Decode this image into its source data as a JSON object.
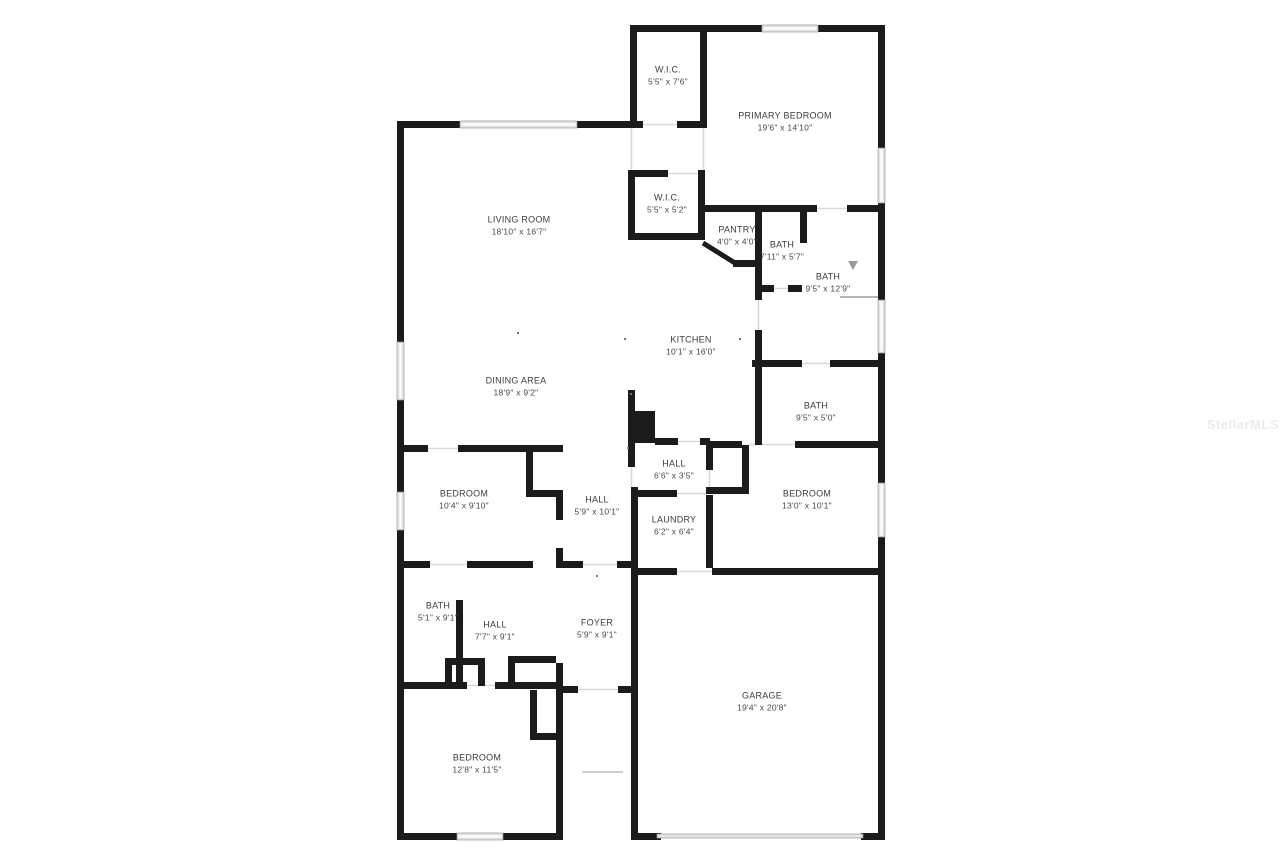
{
  "document": {
    "type": "residential-floor-plan",
    "style": "black-and-white 2D plan"
  },
  "watermark": "StellarMLS",
  "rooms": [
    {
      "id": "wic-1",
      "name": "W.I.C.",
      "dims": "5'5\" x 7'6\""
    },
    {
      "id": "primary-bedroom",
      "name": "PRIMARY BEDROOM",
      "dims": "19'6\" x 14'10\""
    },
    {
      "id": "living-room",
      "name": "LIVING ROOM",
      "dims": "18'10\" x 16'7\""
    },
    {
      "id": "wic-2",
      "name": "W.I.C.",
      "dims": "5'5\" x 5'2\""
    },
    {
      "id": "pantry",
      "name": "PANTRY",
      "dims": "4'0\" x 4'0\""
    },
    {
      "id": "bath-1",
      "name": "BATH",
      "dims": "7'11\" x 5'7\""
    },
    {
      "id": "bath-2",
      "name": "BATH",
      "dims": "9'5\" x 12'9\""
    },
    {
      "id": "kitchen",
      "name": "KITCHEN",
      "dims": "10'1\" x 16'0\""
    },
    {
      "id": "dining-area",
      "name": "DINING AREA",
      "dims": "18'9\" x 9'2\""
    },
    {
      "id": "bath-3",
      "name": "BATH",
      "dims": "9'5\" x 5'0\""
    },
    {
      "id": "hall-1",
      "name": "HALL",
      "dims": "6'6\" x 3'5\""
    },
    {
      "id": "bedroom-1",
      "name": "BEDROOM",
      "dims": "10'4\" x 9'10\""
    },
    {
      "id": "hall-2",
      "name": "HALL",
      "dims": "5'9\" x 10'1\""
    },
    {
      "id": "laundry",
      "name": "LAUNDRY",
      "dims": "6'2\" x 6'4\""
    },
    {
      "id": "bedroom-2",
      "name": "BEDROOM",
      "dims": "13'0\" x 10'1\""
    },
    {
      "id": "bath-4",
      "name": "BATH",
      "dims": "5'1\" x 9'1\""
    },
    {
      "id": "hall-3",
      "name": "HALL",
      "dims": "7'7\" x 9'1\""
    },
    {
      "id": "foyer",
      "name": "FOYER",
      "dims": "5'9\" x 9'1\""
    },
    {
      "id": "garage",
      "name": "GARAGE",
      "dims": "19'4\" x 20'8\""
    },
    {
      "id": "bedroom-3",
      "name": "BEDROOM",
      "dims": "12'8\" x 11'5\""
    }
  ],
  "colors": {
    "background": "#ffffff",
    "wall": "#1b1b1b",
    "window_fill": "#e4e4e4",
    "window_edge": "#9a9a9a",
    "opening_line": "#d9d9d9",
    "label_text": "#3c3c3c",
    "watermark_text": "#ebebeb"
  }
}
